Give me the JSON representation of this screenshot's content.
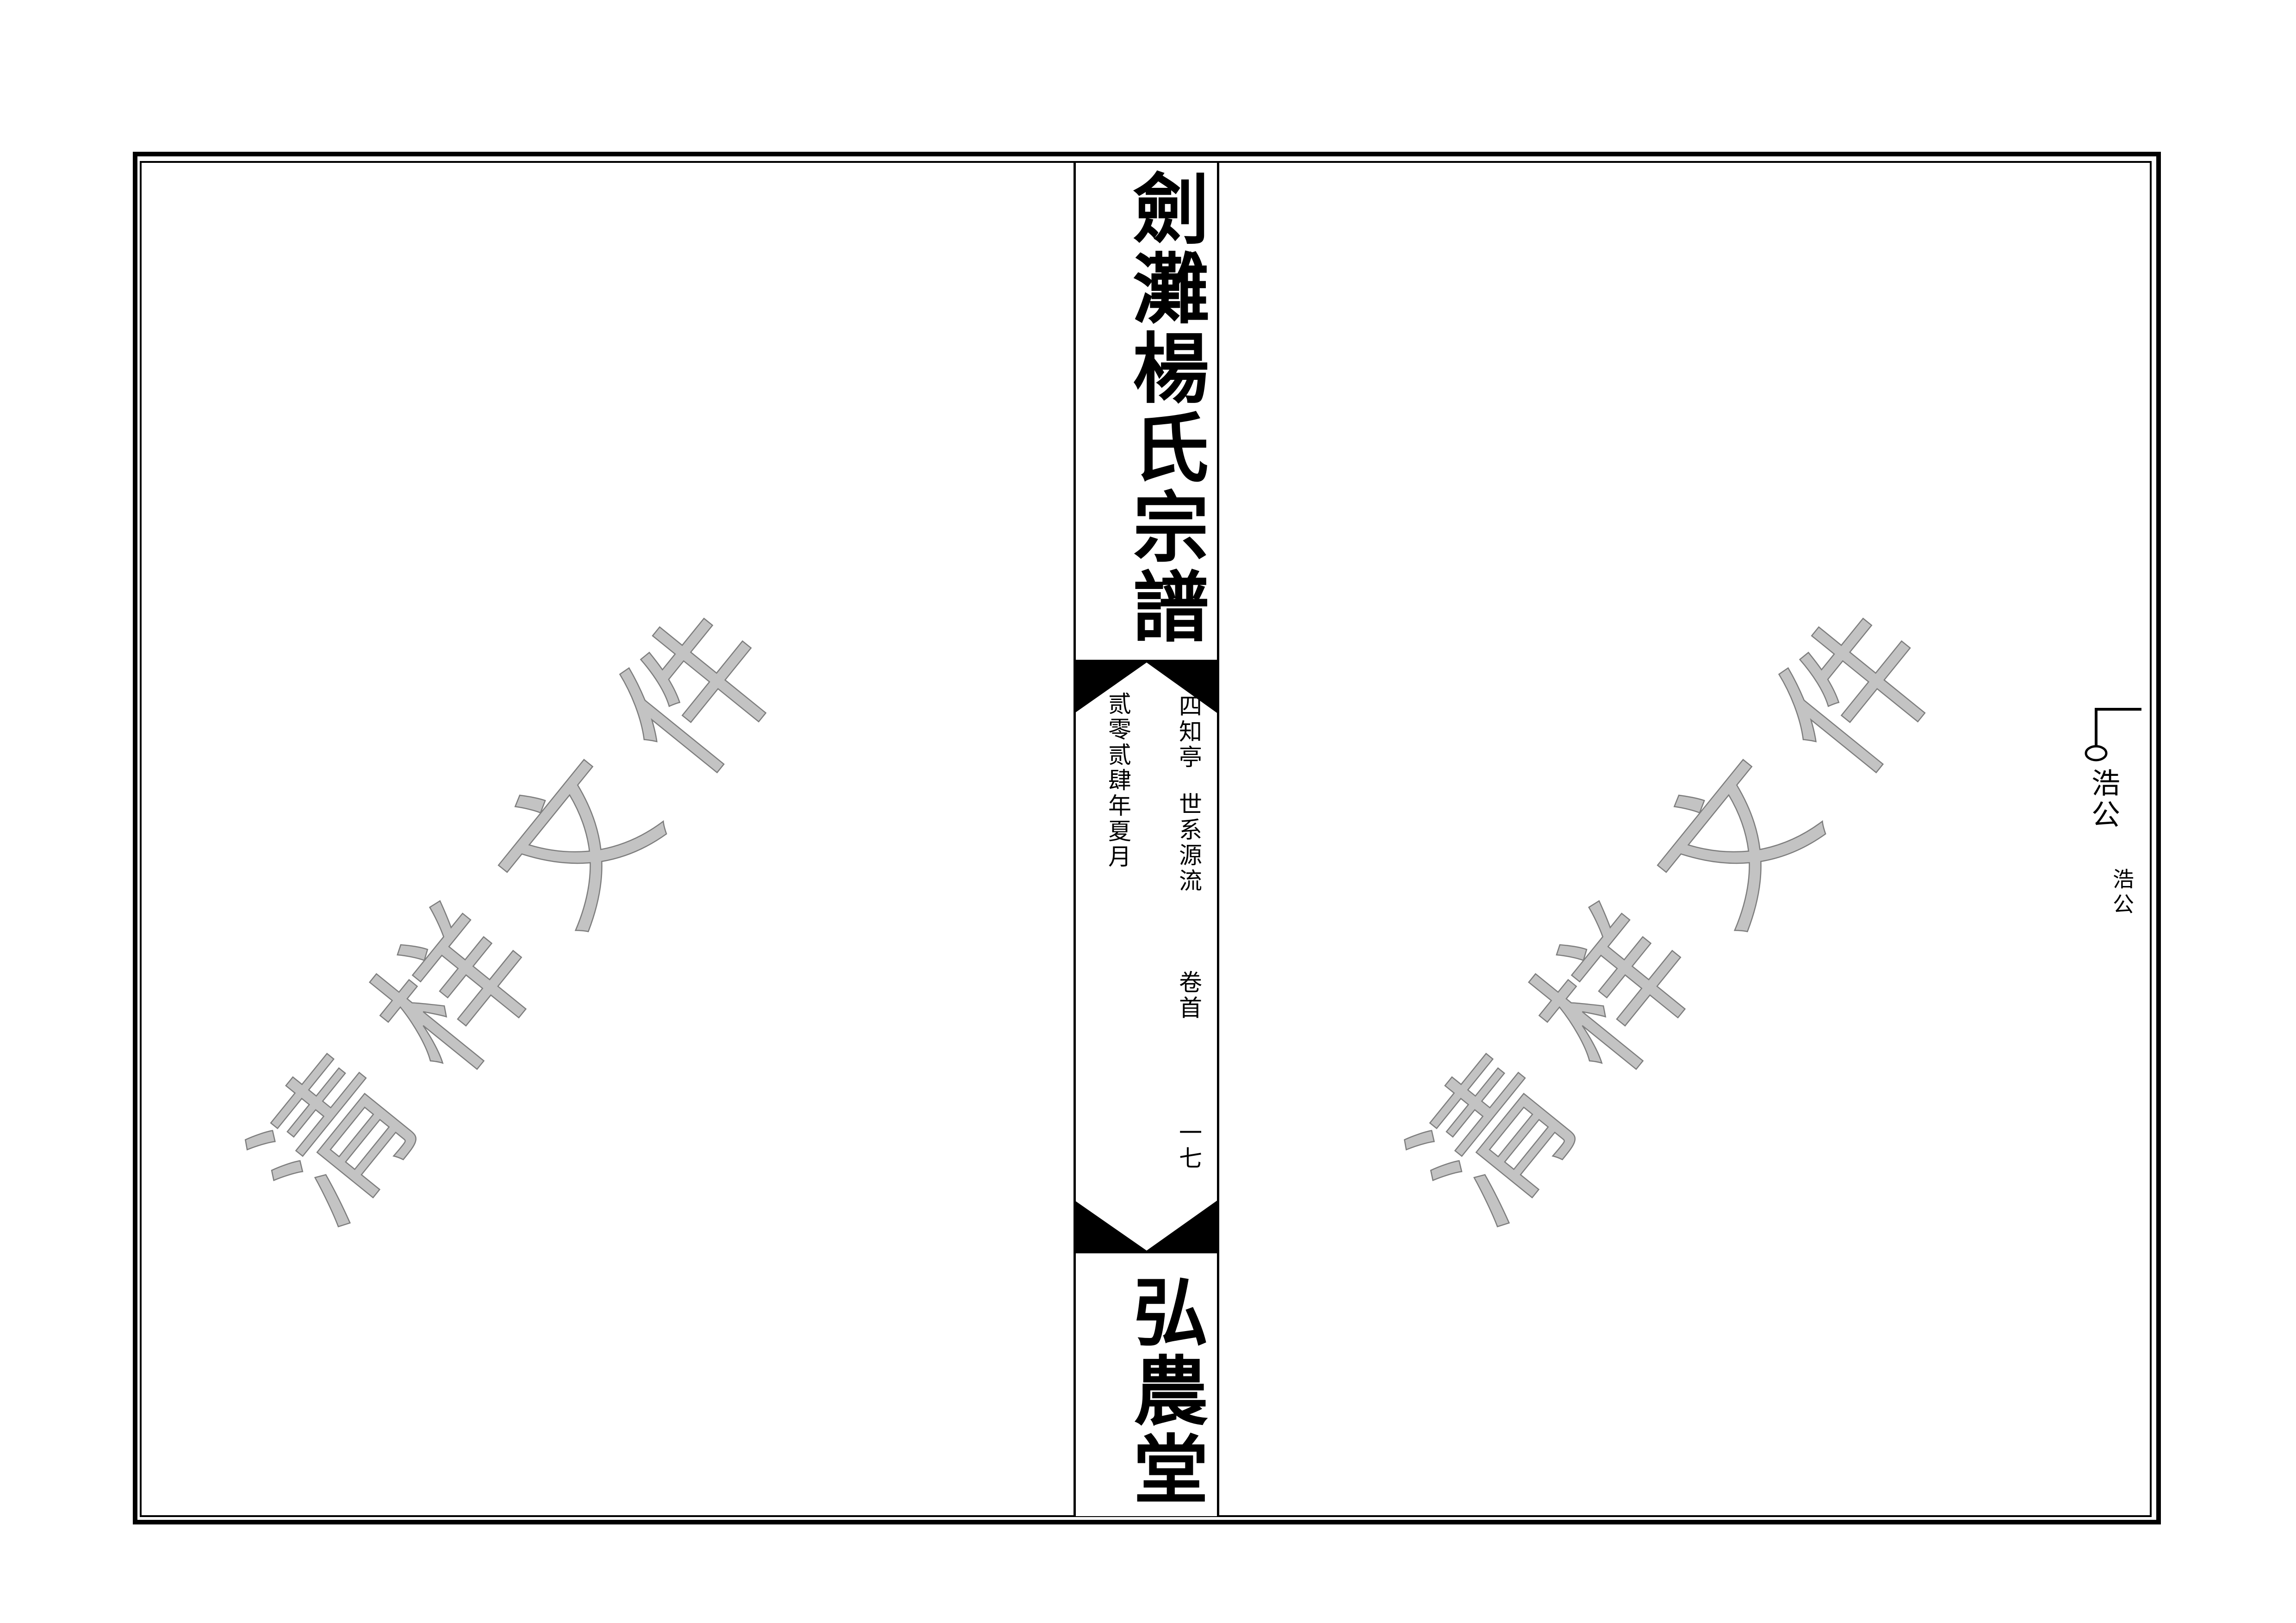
{
  "page": {
    "background_color": "#ffffff",
    "ink_color": "#000000"
  },
  "spine": {
    "title": "劍灘楊氏宗譜",
    "subtitle_column": {
      "pavilion": "四知亭",
      "section": "世系源流",
      "volume": "卷首",
      "volume_number": "一七"
    },
    "date_column": "贰零贰肆年夏月",
    "hall": "弘農堂"
  },
  "right_page": {
    "tree_node_label": "浩公",
    "tree_node_note": "浩公"
  },
  "watermark": {
    "text": "清样文件",
    "fill_color": "#c3c3c3",
    "outline_color": "#7d7d7d"
  }
}
